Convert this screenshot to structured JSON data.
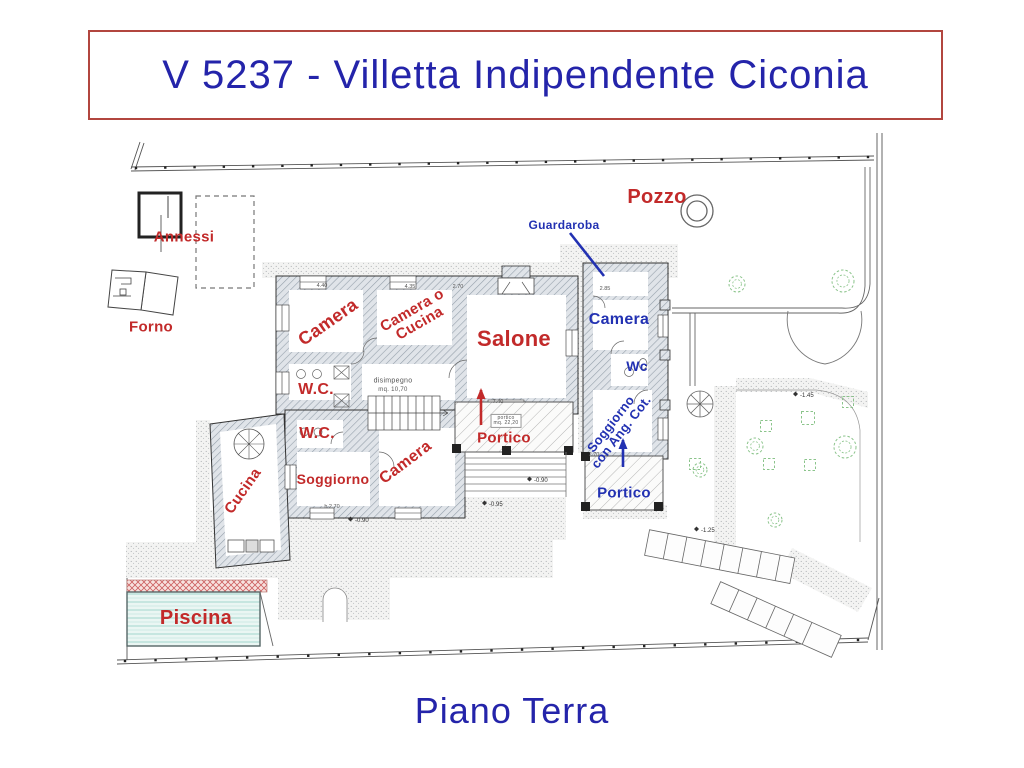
{
  "header": {
    "title": "V 5237 - Villetta Indipendente Ciconia"
  },
  "footer": {
    "caption": "Piano Terra"
  },
  "colors": {
    "red": "#c22a2a",
    "blue": "#2231b2",
    "title_blue": "#2424aa",
    "border_red": "#b2463f",
    "dim": "#555555",
    "tree_green": "#8bc48b",
    "pool_water": "#eaf6f3",
    "pool_stripe": "#a2d5cd"
  },
  "plan": {
    "labels": [
      {
        "id": "pozzo",
        "text": "Pozzo",
        "color": "red",
        "x": 657,
        "y": 197,
        "size": 20,
        "rot": 0
      },
      {
        "id": "annessi",
        "text": "Annessi",
        "color": "red",
        "x": 184,
        "y": 237,
        "size": 15,
        "rot": 0
      },
      {
        "id": "forno",
        "text": "Forno",
        "color": "red",
        "x": 151,
        "y": 327,
        "size": 15,
        "rot": 0
      },
      {
        "id": "guardaroba",
        "text": "Guardaroba",
        "color": "blue",
        "x": 564,
        "y": 225,
        "size": 12,
        "rot": 0
      },
      {
        "id": "camera-nord",
        "text": "Camera",
        "color": "red",
        "x": 328,
        "y": 322,
        "size": 18,
        "rot": -35
      },
      {
        "id": "camera-o-cucina",
        "text": "Camera o\nCucina",
        "color": "red",
        "x": 416,
        "y": 317,
        "size": 15,
        "rot": -30
      },
      {
        "id": "salone",
        "text": "Salone",
        "color": "red",
        "x": 514,
        "y": 339,
        "size": 22,
        "rot": 0
      },
      {
        "id": "camera-est",
        "text": "Camera",
        "color": "blue",
        "x": 619,
        "y": 320,
        "size": 16,
        "rot": 0
      },
      {
        "id": "wc-est",
        "text": "Wc",
        "color": "blue",
        "x": 637,
        "y": 366,
        "size": 14,
        "rot": 0
      },
      {
        "id": "soggiorno-ang-cot",
        "text": "Soggiorno\ncon Ang. Cot.",
        "color": "blue",
        "x": 616,
        "y": 428,
        "size": 13,
        "rot": -52
      },
      {
        "id": "wc-1",
        "text": "W.C.",
        "color": "red",
        "x": 316,
        "y": 390,
        "size": 16,
        "rot": 0
      },
      {
        "id": "wc-2",
        "text": "W.C.",
        "color": "red",
        "x": 317,
        "y": 434,
        "size": 16,
        "rot": 0
      },
      {
        "id": "portico-sud",
        "text": "Portico",
        "color": "red",
        "x": 504,
        "y": 438,
        "size": 15,
        "rot": 0
      },
      {
        "id": "portico-est",
        "text": "Portico",
        "color": "blue",
        "x": 624,
        "y": 493,
        "size": 15,
        "rot": 0
      },
      {
        "id": "soggiorno-ovest",
        "text": "Soggiorno",
        "color": "red",
        "x": 333,
        "y": 479,
        "size": 14,
        "rot": 0
      },
      {
        "id": "camera-sud",
        "text": "Camera",
        "color": "red",
        "x": 406,
        "y": 463,
        "size": 16,
        "rot": -37
      },
      {
        "id": "cucina",
        "text": "Cucina",
        "color": "red",
        "x": 243,
        "y": 491,
        "size": 15,
        "rot": -55
      },
      {
        "id": "piscina",
        "text": "Piscina",
        "color": "red",
        "x": 196,
        "y": 618,
        "size": 20,
        "rot": 0
      },
      {
        "id": "disimpegno",
        "text": "disimpegno",
        "color": "dim",
        "x": 393,
        "y": 381,
        "size": 7,
        "rot": 0,
        "bold": false
      },
      {
        "id": "disimpegno-mq",
        "text": "mq. 10,70",
        "color": "dim",
        "x": 393,
        "y": 390,
        "size": 6,
        "rot": 0,
        "bold": false
      },
      {
        "id": "portico-mq",
        "text": "portico\nmq. 22,20",
        "color": "dim",
        "x": 506,
        "y": 421,
        "size": 5,
        "rot": 0,
        "bold": false,
        "box": true
      }
    ],
    "dims": [
      {
        "x": 322,
        "y": 287,
        "text": "4.40"
      },
      {
        "x": 410,
        "y": 288,
        "text": "4.35"
      },
      {
        "x": 458,
        "y": 288,
        "text": "2.70"
      },
      {
        "x": 605,
        "y": 290,
        "text": "2.85"
      },
      {
        "x": 498,
        "y": 403,
        "text": "7.40"
      },
      {
        "x": 594,
        "y": 456,
        "text": "2.70"
      },
      {
        "x": 332,
        "y": 508,
        "text": "h 2.70"
      }
    ],
    "spot_elevations": [
      {
        "x": 537,
        "y": 481,
        "text": "-0.90"
      },
      {
        "x": 492,
        "y": 505,
        "text": "-0.95"
      },
      {
        "x": 358,
        "y": 521,
        "text": "-0.90"
      },
      {
        "x": 704,
        "y": 531,
        "text": "-1.25"
      },
      {
        "x": 803,
        "y": 396,
        "text": "-1.45"
      }
    ],
    "arrows": [
      {
        "id": "entrance-arrow-south",
        "color": "red",
        "x": 481,
        "y1": 425,
        "y2": 390
      },
      {
        "id": "entrance-arrow-east",
        "color": "blue",
        "x": 623,
        "y1": 467,
        "y2": 440
      }
    ],
    "leader": {
      "id": "guardaroba-leader",
      "color": "blue",
      "x1": 570,
      "y1": 233,
      "x2": 604,
      "y2": 276
    },
    "trees": [
      {
        "x": 737,
        "y": 284,
        "r": 8
      },
      {
        "x": 843,
        "y": 281,
        "r": 11
      },
      {
        "x": 755,
        "y": 446,
        "r": 8
      },
      {
        "x": 845,
        "y": 447,
        "r": 11
      },
      {
        "x": 700,
        "y": 470,
        "r": 7
      },
      {
        "x": 775,
        "y": 520,
        "r": 7
      }
    ],
    "planters": [
      {
        "x": 808,
        "y": 418,
        "s": 13
      },
      {
        "x": 766,
        "y": 426,
        "s": 11
      },
      {
        "x": 848,
        "y": 402,
        "s": 11
      },
      {
        "x": 695,
        "y": 464,
        "s": 11
      },
      {
        "x": 769,
        "y": 464,
        "s": 11
      },
      {
        "x": 810,
        "y": 465,
        "s": 11
      }
    ]
  }
}
